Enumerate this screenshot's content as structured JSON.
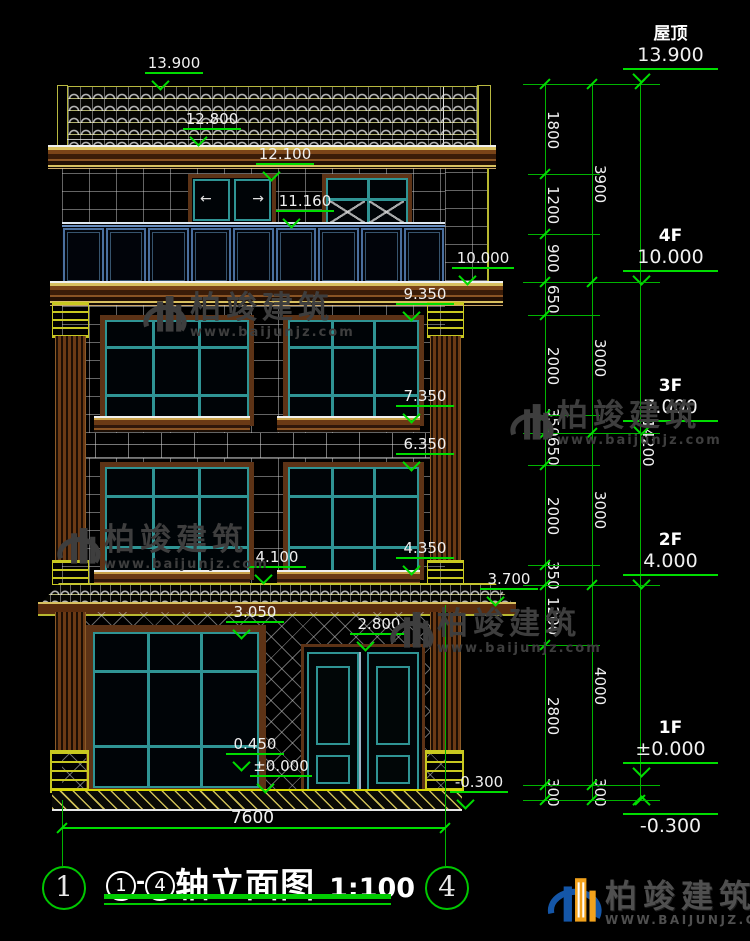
{
  "drawing": {
    "title": {
      "axis_start": "1",
      "dash": "-",
      "axis_end": "4",
      "name": "轴立面图",
      "scale": "1:100"
    },
    "total_width_dim": "7600",
    "axis_bubbles": {
      "left": "1",
      "right": "4"
    }
  },
  "levels": {
    "roof": {
      "label": "屋顶",
      "value": "13.900"
    },
    "f4": {
      "label": "4F",
      "value": "10.000"
    },
    "f3": {
      "label": "3F",
      "value": "7.000"
    },
    "f2": {
      "label": "2F",
      "value": "4.000"
    },
    "f1": {
      "label": "1F",
      "value": "±0.000"
    },
    "base": {
      "value": "-0.300"
    }
  },
  "marks": {
    "m13900": "13.900",
    "m12800": "12.800",
    "m12100": "12.100",
    "m11160": "11.160",
    "m10000": "10.000",
    "m9350": "9.350",
    "m7350": "7.350",
    "m6350": "6.350",
    "m4350": "4.350",
    "m4100": "4.100",
    "m3700": "3.700",
    "m3050": "3.050",
    "m2800": "2.800",
    "m0450": "0.450",
    "m0000": "±0.000",
    "mn0300": "-0.300"
  },
  "chains": {
    "c1": [
      "1800",
      "1200",
      "900",
      "650",
      "2000",
      "350",
      "650",
      "2000",
      "350",
      "1200",
      "2800",
      "300"
    ],
    "c2": [
      "3900",
      "3000",
      "3000",
      "4000",
      "300"
    ],
    "c3": [
      "14200"
    ]
  },
  "watermark": {
    "brand": "柏竣建筑",
    "site": "www.baijunjz.com"
  },
  "footer_logo": {
    "brand": "柏竣建筑",
    "site": "WWW.BAIJUNJZ.COM"
  },
  "colors": {
    "dimension_green": "#00dc00",
    "text_white": "#f0f0f0",
    "frame_teal": "#2f9494",
    "trim_brown": "#5d3316",
    "trim_yellow": "#c8c830",
    "railing_blue": "#4a6f9e",
    "logo_blue": "#1456a8",
    "logo_orange": "#f2a21c",
    "watermark_gray": "#3e3e3e"
  }
}
